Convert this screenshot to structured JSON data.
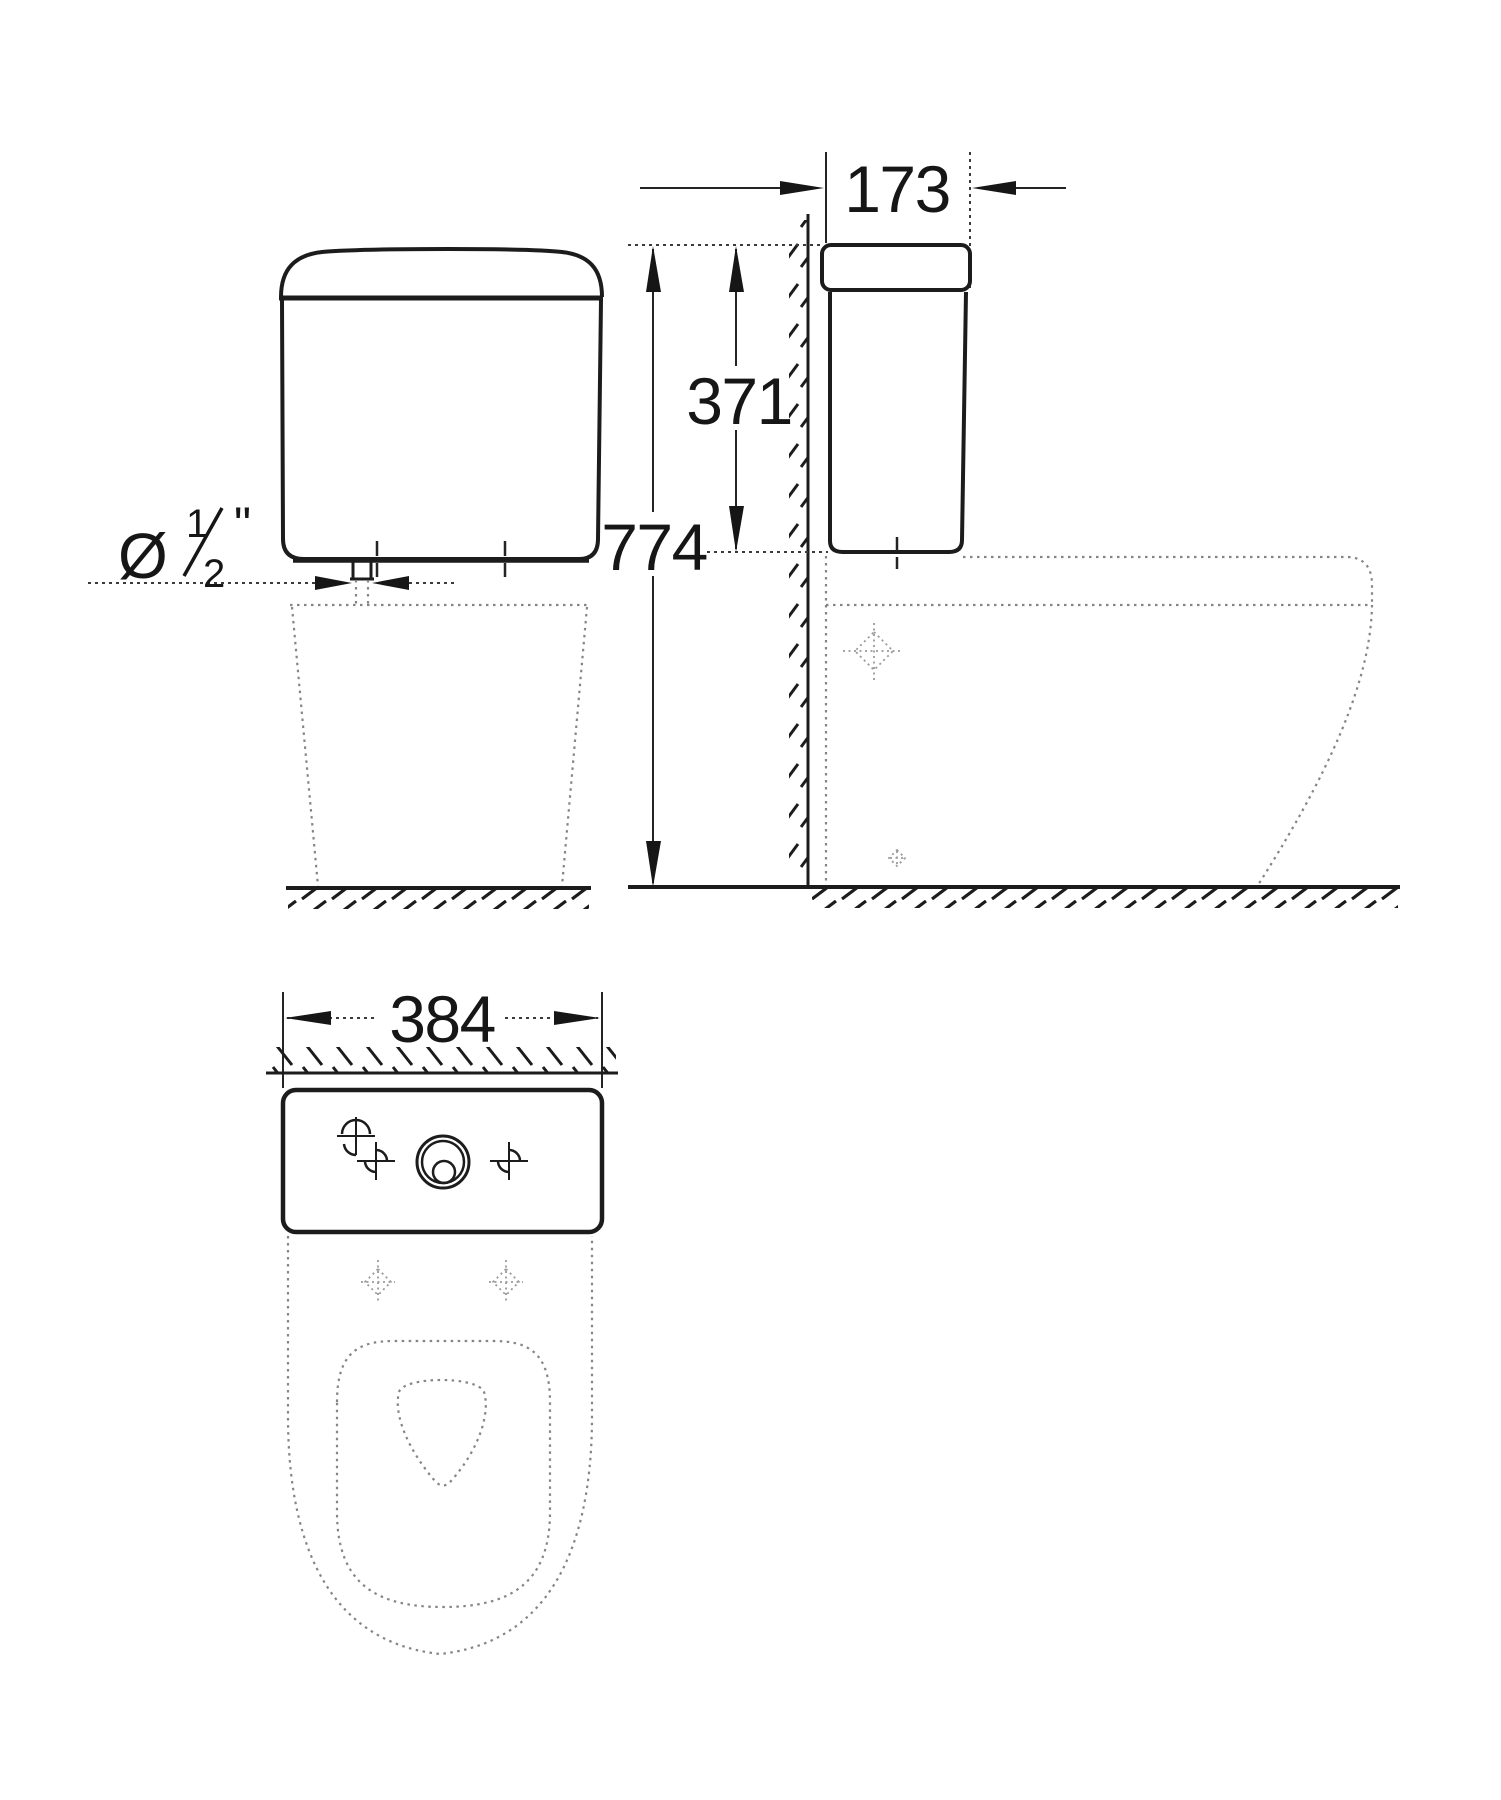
{
  "labels": {
    "depth_mm": "173",
    "cistern_height_mm": "371",
    "total_height_mm": "774",
    "width_mm": "384",
    "inlet_diameter_symbol": "Ø",
    "inlet_fraction_numerator": "1",
    "inlet_fraction_denominator": "2",
    "inlet_unit": "\"",
    "inlet_full_label": "Ø½\""
  },
  "colors": {
    "line": "#1c1c1c",
    "dimension": "#242424",
    "hidden_line": "#858585",
    "marker": "#9a9a9a",
    "background": "#ffffff"
  }
}
